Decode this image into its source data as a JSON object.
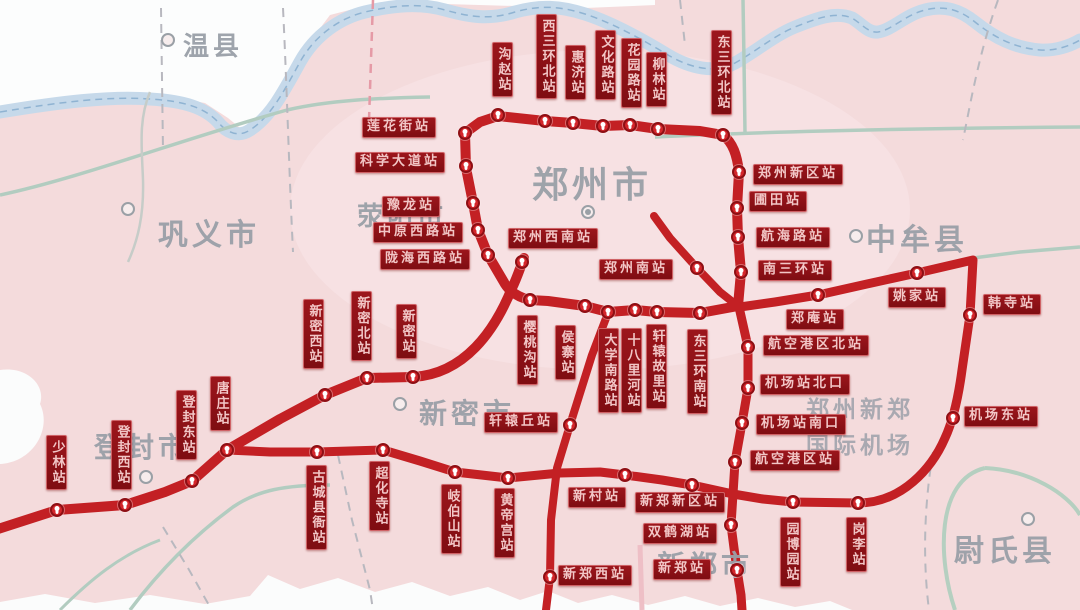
{
  "map": {
    "colors": {
      "background_pink": "#f4dbdc",
      "route_red": "#c32024",
      "station_label_bg": "#8f1117",
      "station_label_text": "#f2c6c6",
      "river_blue": "#c6d9ea",
      "road_green": "#b2ccc0",
      "boundary_gray": "#b8b8bf",
      "city_text_gray": "#9aa0a8"
    },
    "cities": [
      {
        "name": "温县",
        "x": 183,
        "y": 26,
        "size": 26,
        "dot": [
          168,
          40
        ],
        "dot_type": "ring"
      },
      {
        "name": "巩义市",
        "x": 158,
        "y": 210,
        "size": 30,
        "dot": [
          128,
          209
        ],
        "dot_type": "ring"
      },
      {
        "name": "荥阳市",
        "x": 357,
        "y": 196,
        "size": 26,
        "dot": null,
        "dot_type": null
      },
      {
        "name": "郑州市",
        "x": 532,
        "y": 156,
        "size": 36,
        "dot": [
          588,
          212
        ],
        "dot_type": "double"
      },
      {
        "name": "中牟县",
        "x": 866,
        "y": 215,
        "size": 30,
        "dot": [
          856,
          236
        ],
        "dot_type": "ring"
      },
      {
        "name": "新密市",
        "x": 419,
        "y": 392,
        "size": 28,
        "dot": [
          400,
          404
        ],
        "dot_type": "ring"
      },
      {
        "name": "登封市",
        "x": 94,
        "y": 426,
        "size": 28,
        "dot": [
          146,
          477
        ],
        "dot_type": "ring"
      },
      {
        "name": "新郑市",
        "x": 657,
        "y": 544,
        "size": 28,
        "dot": null,
        "dot_type": null
      },
      {
        "name": "尉氏县",
        "x": 954,
        "y": 526,
        "size": 30,
        "dot": [
          1028,
          519
        ],
        "dot_type": "ring"
      }
    ],
    "airport_label": {
      "line1": "郑州新郑",
      "line2": "国际机场",
      "icon_glyph": "✈",
      "x": 806,
      "y": 390
    },
    "stations": [
      {
        "name": "沟赵站",
        "o": "v",
        "lx": 492,
        "ly": 42,
        "mx": 498,
        "my": 115
      },
      {
        "name": "西三环北站",
        "o": "v",
        "lx": 536,
        "ly": 14,
        "mx": 545,
        "my": 121
      },
      {
        "name": "惠济站",
        "o": "v",
        "lx": 565,
        "ly": 45,
        "mx": 573,
        "my": 123
      },
      {
        "name": "文化路站",
        "o": "v",
        "lx": 595,
        "ly": 30,
        "mx": 603,
        "my": 126
      },
      {
        "name": "花园路站",
        "o": "v",
        "lx": 621,
        "ly": 38,
        "mx": 630,
        "my": 125
      },
      {
        "name": "柳林站",
        "o": "v",
        "lx": 646,
        "ly": 52,
        "mx": 658,
        "my": 129
      },
      {
        "name": "东三环北站",
        "o": "v",
        "lx": 711,
        "ly": 30,
        "mx": 723,
        "my": 135
      },
      {
        "name": "莲花街站",
        "o": "h",
        "lx": 362,
        "ly": 117,
        "mx": 465,
        "my": 133
      },
      {
        "name": "科学大道站",
        "o": "h",
        "lx": 355,
        "ly": 152,
        "mx": 466,
        "my": 166
      },
      {
        "name": "豫龙站",
        "o": "h",
        "lx": 382,
        "ly": 196,
        "mx": 473,
        "my": 203
      },
      {
        "name": "中原西路站",
        "o": "h",
        "lx": 373,
        "ly": 222,
        "mx": 478,
        "my": 230
      },
      {
        "name": "陇海西路站",
        "o": "h",
        "lx": 380,
        "ly": 249,
        "mx": 488,
        "my": 255
      },
      {
        "name": "郑州西南站",
        "o": "h",
        "lx": 508,
        "ly": 228,
        "mx": 522,
        "my": 262
      },
      {
        "name": "郑州南站",
        "o": "h",
        "lx": 599,
        "ly": 259,
        "mx": 697,
        "my": 268
      },
      {
        "name": "郑州新区站",
        "o": "h",
        "lx": 753,
        "ly": 164,
        "mx": 739,
        "my": 172
      },
      {
        "name": "圃田站",
        "o": "h",
        "lx": 749,
        "ly": 191,
        "mx": 737,
        "my": 208
      },
      {
        "name": "航海路站",
        "o": "h",
        "lx": 756,
        "ly": 227,
        "mx": 738,
        "my": 237
      },
      {
        "name": "南三环站",
        "o": "h",
        "lx": 758,
        "ly": 260,
        "mx": 741,
        "my": 272
      },
      {
        "name": "郑庵站",
        "o": "h",
        "lx": 786,
        "ly": 309,
        "mx": 818,
        "my": 295
      },
      {
        "name": "航空港区北站",
        "o": "h",
        "lx": 763,
        "ly": 335,
        "mx": 748,
        "my": 347
      },
      {
        "name": "姚家站",
        "o": "h",
        "lx": 888,
        "ly": 287,
        "mx": 917,
        "my": 273
      },
      {
        "name": "韩寺站",
        "o": "h",
        "lx": 983,
        "ly": 294,
        "mx": 970,
        "my": 315
      },
      {
        "name": "机场站北口",
        "o": "h",
        "lx": 760,
        "ly": 374,
        "mx": 748,
        "my": 388
      },
      {
        "name": "机场站南口",
        "o": "h",
        "lx": 756,
        "ly": 414,
        "mx": 742,
        "my": 423
      },
      {
        "name": "航空港区站",
        "o": "h",
        "lx": 750,
        "ly": 450,
        "mx": 735,
        "my": 462
      },
      {
        "name": "机场东站",
        "o": "h",
        "lx": 964,
        "ly": 406,
        "mx": 953,
        "my": 418
      },
      {
        "name": "樱桃沟站",
        "o": "v",
        "lx": 517,
        "ly": 315,
        "mx": 530,
        "my": 300
      },
      {
        "name": "侯寨站",
        "o": "v",
        "lx": 555,
        "ly": 325,
        "mx": 585,
        "my": 306
      },
      {
        "name": "大学南路站",
        "o": "v",
        "lx": 598,
        "ly": 328,
        "mx": 608,
        "my": 312
      },
      {
        "name": "十八里河站",
        "o": "v",
        "lx": 621,
        "ly": 328,
        "mx": 635,
        "my": 310
      },
      {
        "name": "轩辕故里站",
        "o": "v",
        "lx": 646,
        "ly": 324,
        "mx": 657,
        "my": 312
      },
      {
        "name": "东三环南站",
        "o": "v",
        "lx": 687,
        "ly": 329,
        "mx": 700,
        "my": 313
      },
      {
        "name": "新密西站",
        "o": "v",
        "lx": 303,
        "ly": 299,
        "mx": 325,
        "my": 395
      },
      {
        "name": "新密北站",
        "o": "v",
        "lx": 351,
        "ly": 291,
        "mx": 367,
        "my": 378
      },
      {
        "name": "新密站",
        "o": "v",
        "lx": 396,
        "ly": 304,
        "mx": 413,
        "my": 377
      },
      {
        "name": "轩辕丘站",
        "o": "h",
        "lx": 484,
        "ly": 412,
        "mx": 570,
        "my": 425
      },
      {
        "name": "唐庄站",
        "o": "v",
        "lx": 210,
        "ly": 376,
        "mx": 227,
        "my": 450
      },
      {
        "name": "登封东站",
        "o": "v",
        "lx": 176,
        "ly": 390,
        "mx": 192,
        "my": 481
      },
      {
        "name": "登封西站",
        "o": "v",
        "lx": 111,
        "ly": 420,
        "mx": 125,
        "my": 505
      },
      {
        "name": "少林站",
        "o": "v",
        "lx": 46,
        "ly": 435,
        "mx": 57,
        "my": 510
      },
      {
        "name": "古城县衙站",
        "o": "v",
        "lx": 306,
        "ly": 465,
        "mx": 317,
        "my": 452
      },
      {
        "name": "超化寺站",
        "o": "v",
        "lx": 369,
        "ly": 461,
        "mx": 383,
        "my": 450
      },
      {
        "name": "岐伯山站",
        "o": "v",
        "lx": 441,
        "ly": 484,
        "mx": 455,
        "my": 472
      },
      {
        "name": "黄帝宫站",
        "o": "v",
        "lx": 494,
        "ly": 488,
        "mx": 508,
        "my": 478
      },
      {
        "name": "新村站",
        "o": "h",
        "lx": 568,
        "ly": 487,
        "mx": 625,
        "my": 475
      },
      {
        "name": "新郑新区站",
        "o": "h",
        "lx": 635,
        "ly": 492,
        "mx": 692,
        "my": 485
      },
      {
        "name": "双鹤湖站",
        "o": "h",
        "lx": 643,
        "ly": 523,
        "mx": 731,
        "my": 525
      },
      {
        "name": "新郑站",
        "o": "h",
        "lx": 653,
        "ly": 559,
        "mx": 737,
        "my": 570
      },
      {
        "name": "新郑西站",
        "o": "h",
        "lx": 558,
        "ly": 565,
        "mx": 550,
        "my": 577
      },
      {
        "name": "园博园站",
        "o": "v",
        "lx": 780,
        "ly": 517,
        "mx": 793,
        "my": 502
      },
      {
        "name": "岗李站",
        "o": "v",
        "lx": 846,
        "ly": 517,
        "mx": 858,
        "my": 503
      }
    ]
  }
}
